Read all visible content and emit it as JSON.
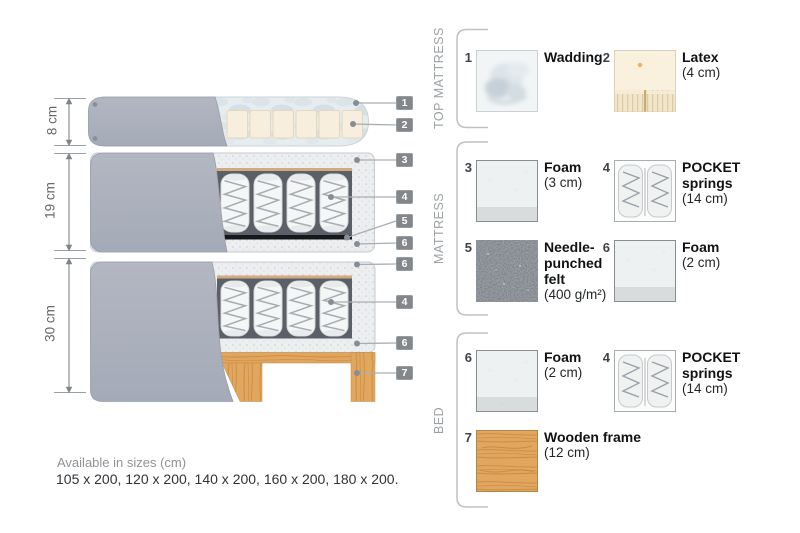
{
  "dims": [
    "8 cm",
    "19 cm",
    "30 cm"
  ],
  "callouts": [
    "1",
    "2",
    "3",
    "4",
    "5",
    "6",
    "6",
    "4",
    "6",
    "7"
  ],
  "legend": {
    "groups": [
      {
        "label": "TOP MATTRESS",
        "items": [
          {
            "num": "1",
            "name": [
              "Wadding"
            ],
            "size": "",
            "swatch": "wadding"
          },
          {
            "num": "2",
            "name": [
              "Latex"
            ],
            "size": "(4 cm)",
            "swatch": "latex"
          }
        ]
      },
      {
        "label": "MATTRESS",
        "items": [
          {
            "num": "3",
            "name": [
              "Foam"
            ],
            "size": "(3 cm)",
            "swatch": "foam"
          },
          {
            "num": "4",
            "name": [
              "POCKET",
              "springs"
            ],
            "size": "(14 cm)",
            "swatch": "pocket-springs"
          },
          {
            "num": "5",
            "name": [
              "Needle-",
              "punched",
              "felt"
            ],
            "size": "(400 g/m²)",
            "swatch": "needle-punched-felt"
          },
          {
            "num": "6",
            "name": [
              "Foam"
            ],
            "size": "(2 cm)",
            "swatch": "foam"
          }
        ]
      },
      {
        "label": "BED",
        "items": [
          {
            "num": "6",
            "name": [
              "Foam"
            ],
            "size": "(2 cm)",
            "swatch": "foam"
          },
          {
            "num": "4",
            "name": [
              "POCKET",
              "springs"
            ],
            "size": "(14 cm)",
            "swatch": "pocket-springs"
          },
          {
            "num": "7",
            "name": [
              "Wooden frame"
            ],
            "size": "(12 cm)",
            "swatch": "wood"
          }
        ]
      }
    ]
  },
  "availability": {
    "label": "Available in sizes (cm)",
    "sizes": "105 x 200, 120 x 200, 140 x 200, 160 x 200, 180 x 200."
  },
  "colors": {
    "fabric": "#aab0bd",
    "wood": "#e0a55c",
    "felt": "#5f6a76",
    "latex": "#f8efdc",
    "foam": "#edf0f0",
    "callout": "#82878b",
    "leader-line": "#aaaeb2",
    "text-dark": "#141618",
    "text-gray": "#9aa0a3"
  }
}
